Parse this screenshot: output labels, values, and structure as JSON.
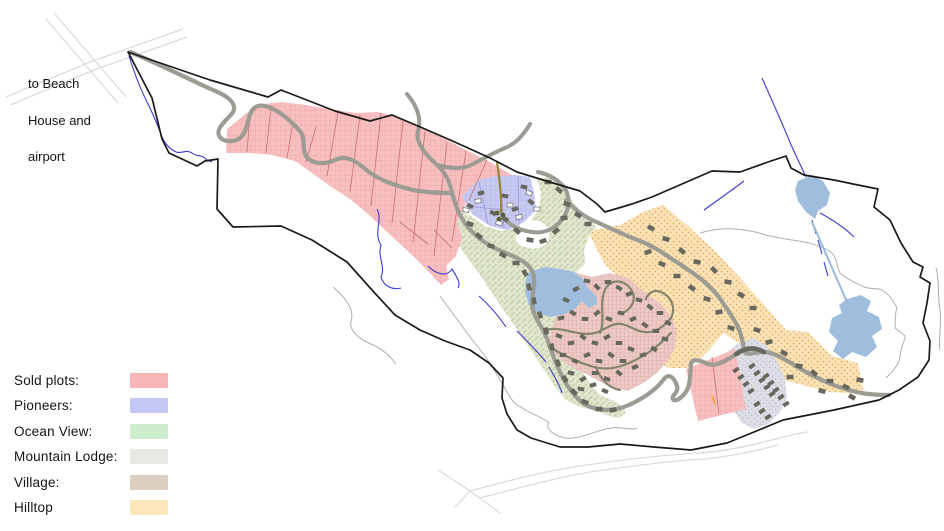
{
  "note": {
    "lines": [
      "to Beach",
      "House and",
      "airport"
    ]
  },
  "legend": {
    "items": [
      {
        "label": "Sold plots:",
        "color": "#f8b6b6"
      },
      {
        "label": "Pioneers:",
        "color": "#c3c7f2"
      },
      {
        "label": "Ocean View:",
        "color": "#cdeccd"
      },
      {
        "label": "Mountain Lodge:",
        "color": "#e8e8e4"
      },
      {
        "label": "Village:",
        "color": "#dccfc2"
      },
      {
        "label": "Hilltop",
        "color": "#fbe7b9"
      }
    ]
  },
  "map": {
    "zones": {
      "sold": {
        "name": "Sold plots",
        "fill": "#f7bfbf",
        "line": "#eda0a0"
      },
      "pioneers": {
        "name": "Pioneers",
        "fill": "#c7c9f1",
        "line": "#aeb2e6"
      },
      "ocean_view": {
        "name": "Ocean View",
        "fill": "#e0e6ce",
        "line": "#b2c08c"
      },
      "mountain_lodge": {
        "name": "Mountain Lodge",
        "fill": "#dddde6",
        "line": "#bdbdd0"
      },
      "village": {
        "name": "Village",
        "fill": "#ecc9c5",
        "line": "#d9a4a0"
      },
      "hilltop": {
        "name": "Hilltop",
        "fill": "#fbe2b4",
        "line": "#dca860"
      }
    },
    "water_color": "#9fbedd",
    "stream_color": "#3b3bd0",
    "road_color": "#9c9c94",
    "boundary_color": "#1a1a1a",
    "building_color": "#68685e",
    "buildings": {
      "pioneers_built": {
        "fill": "#68685e",
        "w": 6.5,
        "h": 4,
        "items": [
          [
            470,
            206,
            20
          ],
          [
            481,
            193,
            -15
          ],
          [
            493,
            213,
            30
          ],
          [
            505,
            196,
            10
          ],
          [
            515,
            209,
            -20
          ],
          [
            524,
            187,
            15
          ],
          [
            531,
            202,
            40
          ]
        ]
      },
      "pioneers_planned": {
        "fill": "#ffffff",
        "stroke": "#77777f",
        "w": 6,
        "h": 4,
        "items": [
          [
            466,
            210,
            10
          ],
          [
            478,
            201,
            -10
          ],
          [
            499,
            223,
            20
          ],
          [
            510,
            205,
            0
          ],
          [
            519,
            217,
            -15
          ],
          [
            529,
            193,
            25
          ],
          [
            537,
            209,
            0
          ]
        ]
      },
      "ocean_view": {
        "fill": "#68685e",
        "w": 7,
        "h": 4.5,
        "items": [
          [
            505,
            219,
            30
          ],
          [
            517,
            231,
            45
          ],
          [
            530,
            240,
            10
          ],
          [
            543,
            241,
            -20
          ],
          [
            556,
            231,
            -40
          ],
          [
            564,
            218,
            -10
          ],
          [
            567,
            204,
            15
          ],
          [
            559,
            190,
            40
          ],
          [
            548,
            182,
            0
          ],
          [
            578,
            215,
            30
          ],
          [
            588,
            224,
            0
          ],
          [
            470,
            224,
            20
          ],
          [
            479,
            236,
            40
          ],
          [
            491,
            246,
            15
          ],
          [
            503,
            255,
            30
          ],
          [
            516,
            263,
            0
          ],
          [
            525,
            273,
            60
          ],
          [
            529,
            287,
            75
          ],
          [
            534,
            301,
            80
          ],
          [
            540,
            315,
            70
          ],
          [
            546,
            331,
            75
          ],
          [
            552,
            347,
            80
          ],
          [
            558,
            363,
            70
          ],
          [
            565,
            379,
            60
          ],
          [
            574,
            392,
            45
          ],
          [
            585,
            402,
            20
          ],
          [
            599,
            409,
            0
          ],
          [
            613,
            410,
            -10
          ]
        ]
      },
      "village": {
        "fill": "#68685e",
        "w": 6.5,
        "h": 4,
        "items": [
          [
            566,
            300,
            20
          ],
          [
            576,
            289,
            -30
          ],
          [
            587,
            281,
            10
          ],
          [
            597,
            287,
            45
          ],
          [
            608,
            282,
            0
          ],
          [
            619,
            288,
            30
          ],
          [
            629,
            294,
            -20
          ],
          [
            639,
            300,
            15
          ],
          [
            650,
            307,
            40
          ],
          [
            660,
            313,
            0
          ],
          [
            668,
            323,
            25
          ],
          [
            561,
            318,
            -15
          ],
          [
            573,
            313,
            30
          ],
          [
            585,
            319,
            0
          ],
          [
            597,
            313,
            -40
          ],
          [
            609,
            319,
            20
          ],
          [
            621,
            313,
            10
          ],
          [
            633,
            319,
            -25
          ],
          [
            645,
            325,
            35
          ],
          [
            656,
            331,
            0
          ],
          [
            665,
            339,
            15
          ],
          [
            559,
            336,
            25
          ],
          [
            571,
            343,
            -10
          ],
          [
            583,
            337,
            40
          ],
          [
            595,
            343,
            15
          ],
          [
            607,
            337,
            -30
          ],
          [
            619,
            343,
            0
          ],
          [
            631,
            349,
            20
          ],
          [
            643,
            355,
            -15
          ],
          [
            654,
            349,
            30
          ],
          [
            563,
            355,
            0
          ],
          [
            575,
            361,
            25
          ],
          [
            587,
            355,
            -20
          ],
          [
            599,
            361,
            10
          ],
          [
            611,
            355,
            35
          ],
          [
            623,
            361,
            0
          ],
          [
            635,
            367,
            -25
          ],
          [
            571,
            373,
            15
          ],
          [
            583,
            379,
            -30
          ],
          [
            595,
            373,
            0
          ],
          [
            607,
            379,
            20
          ],
          [
            619,
            373,
            40
          ],
          [
            581,
            389,
            10
          ],
          [
            593,
            385,
            -15
          ],
          [
            605,
            391,
            25
          ]
        ]
      },
      "hilltop": {
        "fill": "#68685e",
        "w": 7,
        "h": 4.5,
        "items": [
          [
            651,
            228,
            30
          ],
          [
            666,
            239,
            15
          ],
          [
            682,
            251,
            40
          ],
          [
            697,
            262,
            10
          ],
          [
            648,
            252,
            -20
          ],
          [
            662,
            264,
            25
          ],
          [
            677,
            276,
            0
          ],
          [
            692,
            288,
            35
          ],
          [
            707,
            299,
            15
          ],
          [
            719,
            312,
            -10
          ],
          [
            731,
            328,
            20
          ],
          [
            714,
            270,
            45
          ],
          [
            728,
            282,
            10
          ],
          [
            741,
            295,
            30
          ],
          [
            753,
            308,
            0
          ],
          [
            757,
            330,
            20
          ],
          [
            769,
            342,
            -15
          ],
          [
            784,
            353,
            30
          ],
          [
            799,
            366,
            10
          ],
          [
            814,
            373,
            40
          ],
          [
            830,
            381,
            0
          ],
          [
            846,
            387,
            25
          ],
          [
            860,
            380,
            10
          ],
          [
            790,
            377,
            0
          ],
          [
            822,
            391,
            15
          ],
          [
            852,
            397,
            30
          ]
        ]
      },
      "lodge": {
        "fill": "#68685e",
        "w": 6.5,
        "h": 3.8,
        "items": [
          [
            736,
            370,
            -35
          ],
          [
            741,
            377,
            -35
          ],
          [
            746,
            384,
            -35
          ],
          [
            751,
            391,
            -35
          ],
          [
            752,
            366,
            -35
          ],
          [
            757,
            373,
            -35
          ],
          [
            762,
            380,
            -35
          ],
          [
            767,
            387,
            -35
          ],
          [
            772,
            394,
            -35
          ],
          [
            766,
            376,
            -35
          ],
          [
            771,
            383,
            -35
          ],
          [
            776,
            390,
            -35
          ],
          [
            781,
            397,
            -35
          ],
          [
            786,
            404,
            -35
          ],
          [
            757,
            404,
            -35
          ],
          [
            762,
            411,
            -35
          ],
          [
            768,
            417,
            -35
          ]
        ]
      }
    }
  }
}
